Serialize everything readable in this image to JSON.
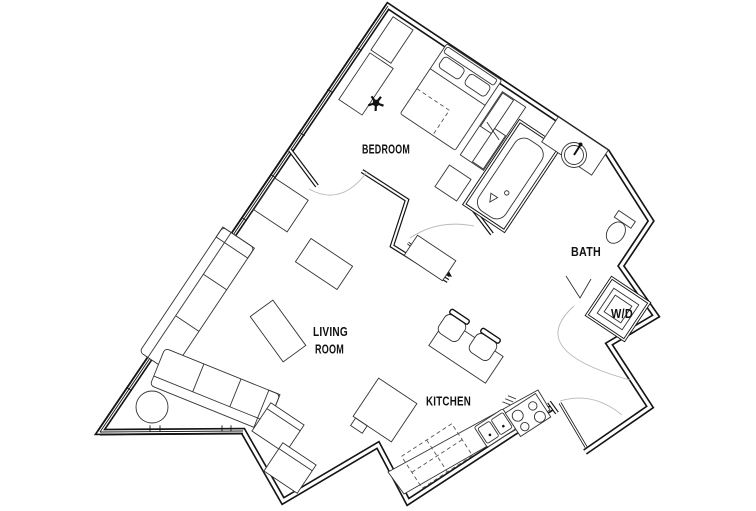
{
  "plan": {
    "background_color": "#ffffff",
    "wall_color": "#151515",
    "furniture_color": "#333333",
    "door_swing_color": "#b9b9b9",
    "label_color": "#111111"
  },
  "rooms": {
    "bedroom": {
      "label": "BEDROOM"
    },
    "bath": {
      "label": "BATH"
    },
    "laundry": {
      "label": "W/D"
    },
    "living_room": {
      "label_line1": "LIVING",
      "label_line2": "ROOM"
    },
    "kitchen": {
      "label": "KITCHEN"
    }
  },
  "fixtures": [
    "bed",
    "desk",
    "office-chair",
    "dresser",
    "wardrobe",
    "bathtub",
    "vanity-sink",
    "toilet",
    "washer-dryer",
    "linen-door",
    "sectional-sofa",
    "armchair",
    "side-table",
    "coffee-table",
    "dining-table",
    "dining-chair",
    "kitchen-counter",
    "kitchen-sink",
    "cooktop",
    "refrigerator",
    "upper-cabinets",
    "entry-door",
    "sliding-door",
    "window-wall"
  ]
}
